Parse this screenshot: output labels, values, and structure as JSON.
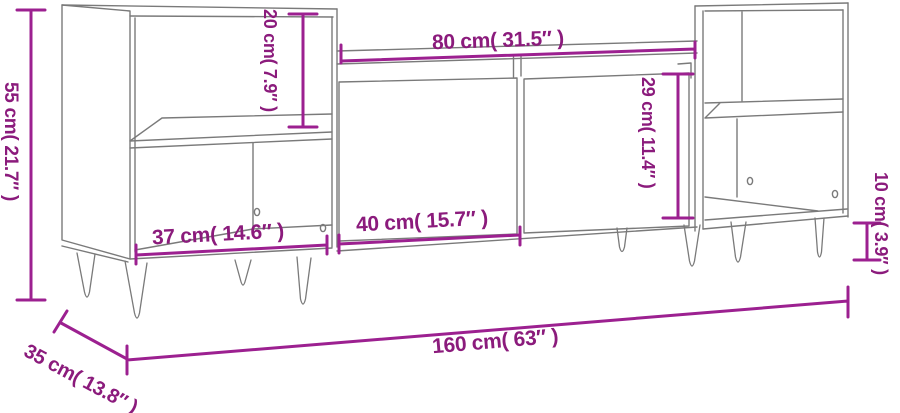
{
  "diagram": {
    "title": "TV cabinet dimension diagram",
    "product": "TV stand with two side shelf units, two sliding doors and hairpin legs",
    "colors": {
      "dimension_line": "#9c2090",
      "dimension_text": "#8b1b7c",
      "line_art": "#7a7a7a",
      "background": "#ffffff"
    },
    "dimensions": {
      "total_height": "55 cm( 21.7″ )",
      "upper_compartment_height": "20 cm( 7.9″ )",
      "middle_top_width": "80 cm( 31.5″ )",
      "door_height": "29 cm( 11.4″ )",
      "left_compartment_width": "37 cm( 14.6″ )",
      "door_width": "40 cm( 15.7″ )",
      "leg_height": "10 cm( 3.9″ )",
      "total_width": "160 cm( 63″ )",
      "depth": "35 cm( 13.8″ )"
    }
  }
}
